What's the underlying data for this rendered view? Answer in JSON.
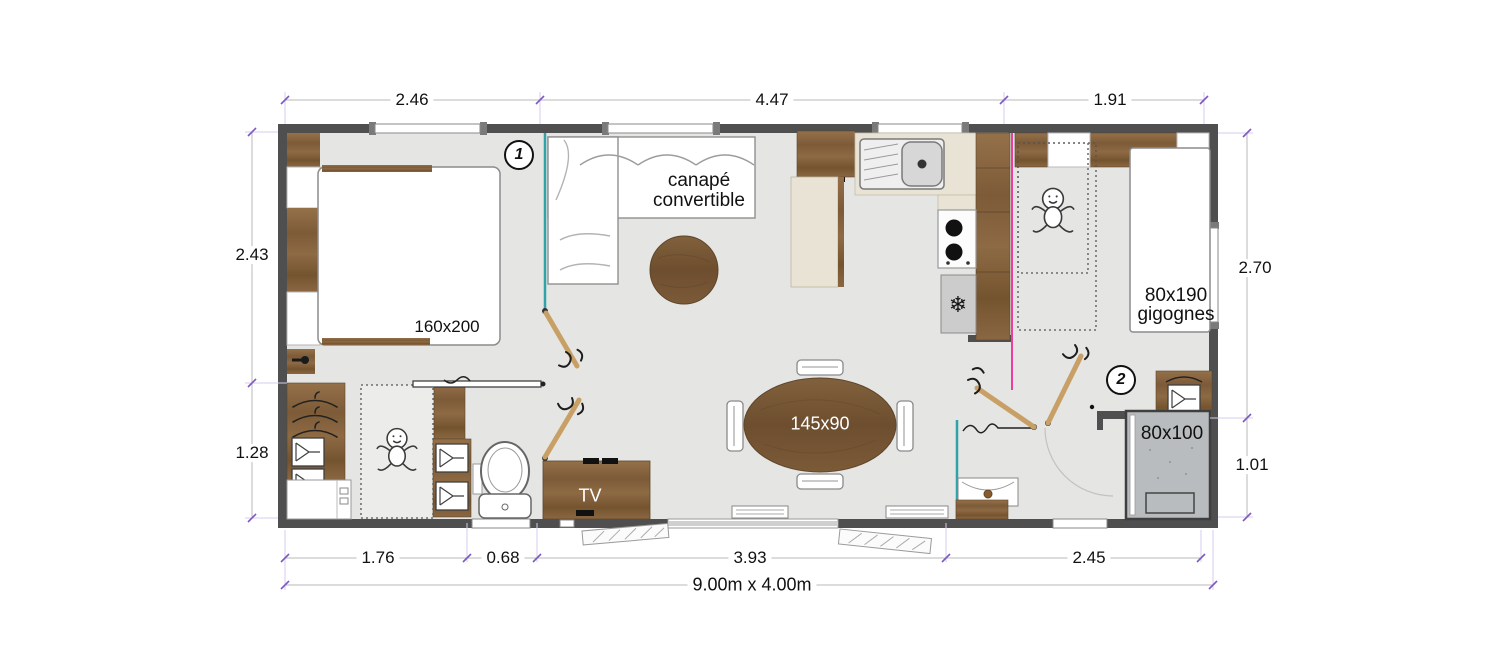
{
  "plan_type": "floorplan",
  "dimensions": {
    "top": [
      "2.46",
      "4.47",
      "1.91"
    ],
    "left": [
      "2.43",
      "1.28"
    ],
    "right": [
      "2.70",
      "1.01"
    ],
    "bottom": [
      "1.76",
      "0.68",
      "3.93",
      "2.45"
    ],
    "overall": "9.00m x 4.00m"
  },
  "rooms": {
    "bedroom1_badge": "1",
    "bedroom2_badge": "2"
  },
  "furniture": {
    "double_bed": "160x200",
    "sofa": "canapé convertible",
    "single_beds_size": "80x190",
    "single_beds_type": "gigognes",
    "dining_table": "145x90",
    "shower": "80x100",
    "tv": "TV"
  },
  "icons": {
    "fridge_snowflake": "❄"
  },
  "colors": {
    "wall": "#4f4f4f",
    "floor": "#e5e5e3",
    "wood": "#855f38",
    "counter_cream": "#e9e3d5",
    "partition_teal": "#2fa3a8",
    "partition_magenta": "#ee3d9c",
    "dimension_tick": "#7e57c2",
    "shower_gray": "#b9bcbe"
  }
}
